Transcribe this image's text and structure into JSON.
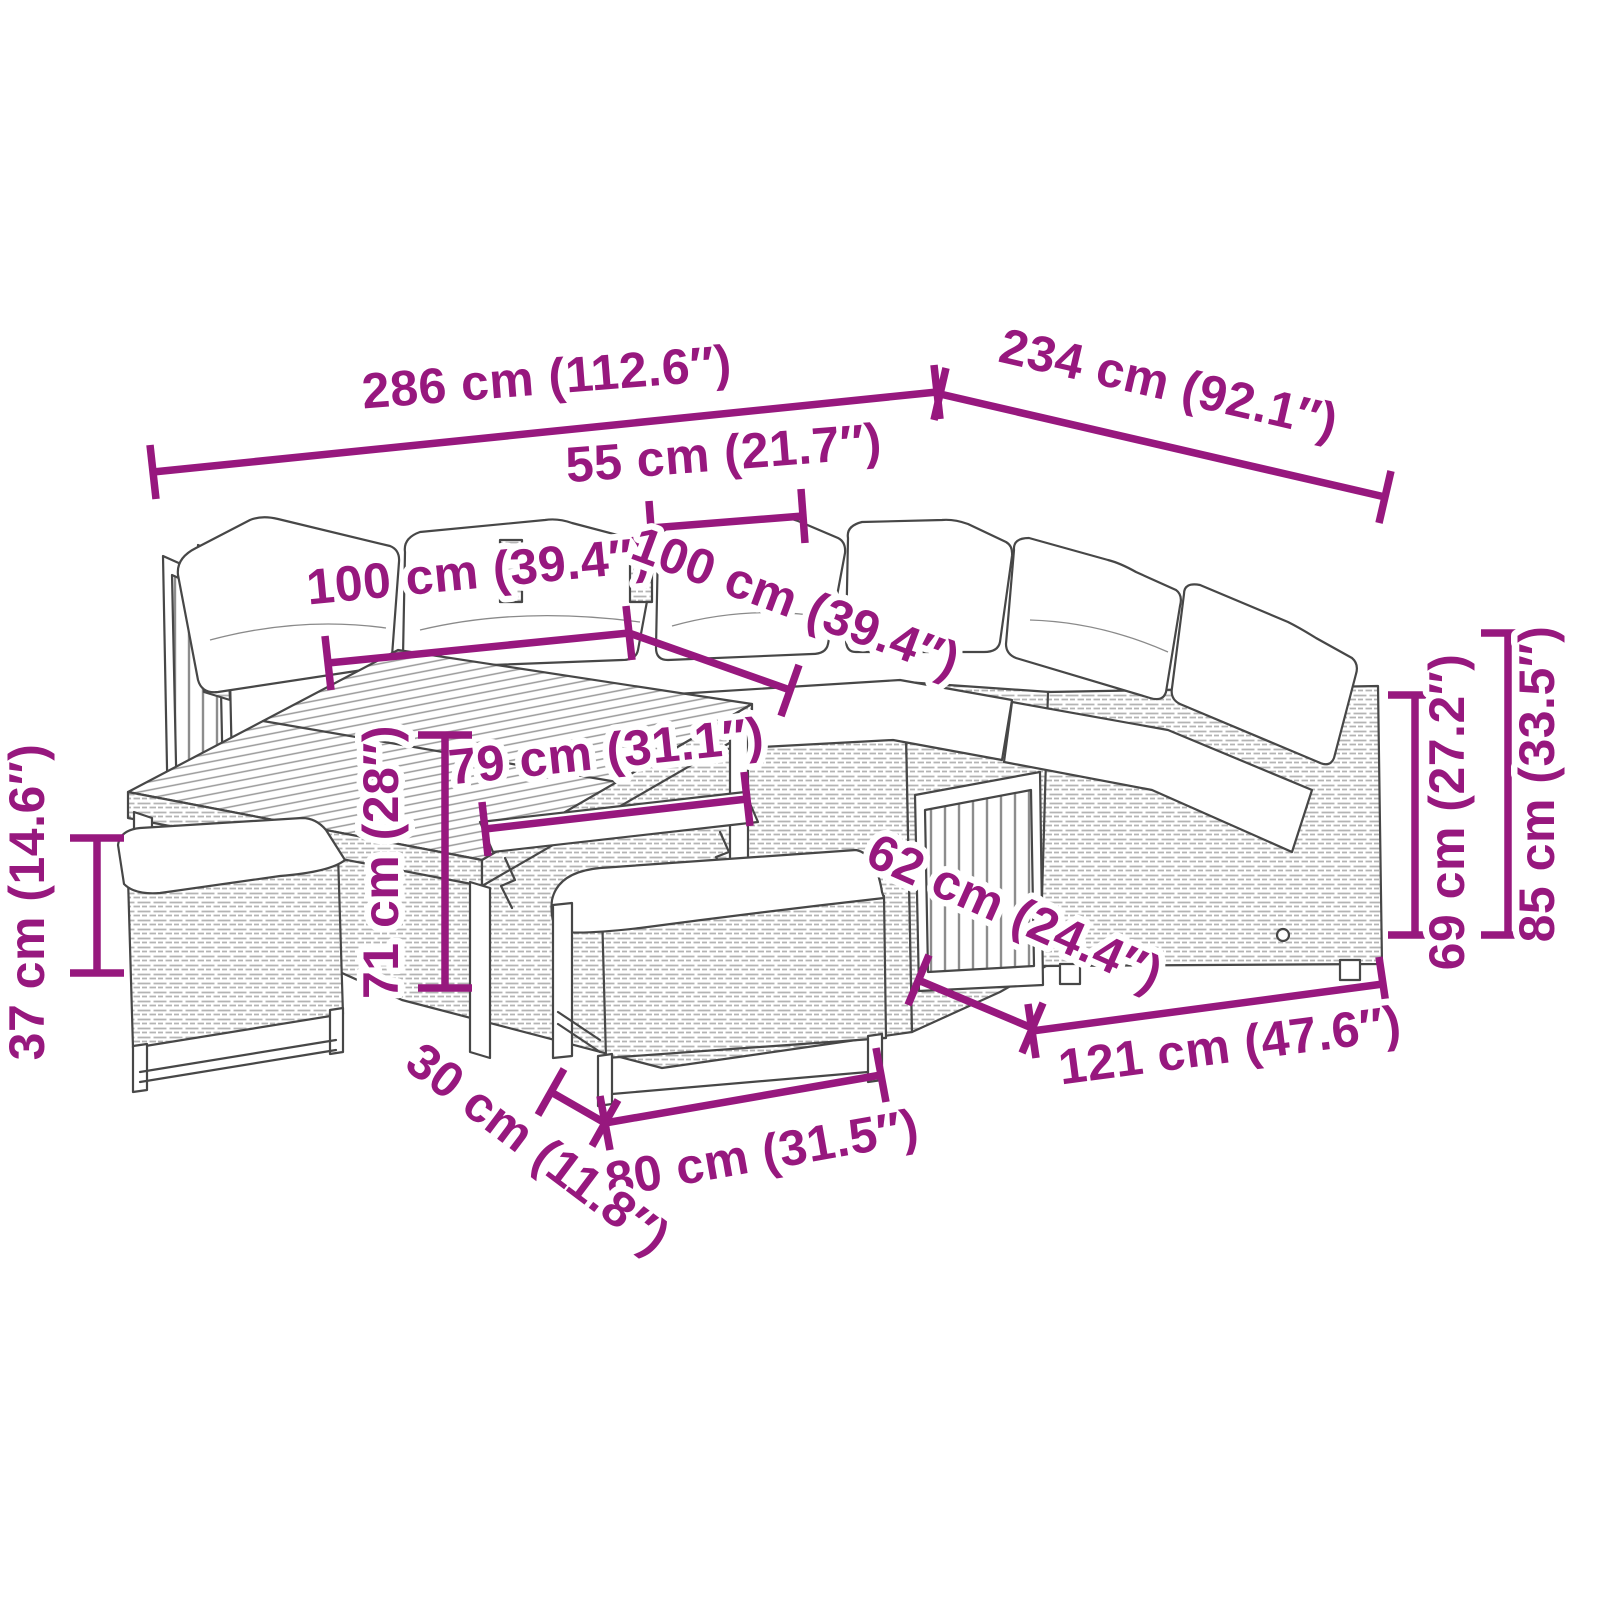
{
  "colors": {
    "dimension_accent": "#97187E",
    "line_art": "#474747",
    "background": "#FFFFFF"
  },
  "dimensions": [
    {
      "id": "total-width",
      "cm": "286 cm",
      "inches": "112.6″",
      "label": "286 cm (112.6″)"
    },
    {
      "id": "total-depth",
      "cm": "234 cm",
      "inches": "92.1″",
      "label": "234 cm (92.1″)"
    },
    {
      "id": "table-top-side",
      "cm": "55 cm",
      "inches": "21.7″",
      "label": "55 cm (21.7″)"
    },
    {
      "id": "left-section",
      "cm": "100 cm",
      "inches": "39.4″",
      "label": "100 cm (39.4″)"
    },
    {
      "id": "right-section",
      "cm": "100 cm",
      "inches": "39.4″",
      "label": "100 cm (39.4″)"
    },
    {
      "id": "table-width",
      "cm": "79 cm",
      "inches": "31.1″",
      "label": "79 cm (31.1″)"
    },
    {
      "id": "table-height",
      "cm": "71 cm",
      "inches": "28″",
      "label": "71 cm (28″)"
    },
    {
      "id": "stool-height",
      "cm": "37 cm",
      "inches": "14.6″",
      "label": "37 cm (14.6″)"
    },
    {
      "id": "seat-depth",
      "cm": "62 cm",
      "inches": "24.4″",
      "label": "62 cm (24.4″)"
    },
    {
      "id": "sofa-width",
      "cm": "121 cm",
      "inches": "47.6″",
      "label": "121 cm (47.6″)"
    },
    {
      "id": "bench-width",
      "cm": "80 cm",
      "inches": "31.5″",
      "label": "80 cm (31.5″)"
    },
    {
      "id": "bench-depth",
      "cm": "30 cm",
      "inches": "11.8″",
      "label": "30 cm (11.8″)"
    },
    {
      "id": "back-height",
      "cm": "69 cm",
      "inches": "27.2″",
      "label": "69 cm (27.2″)"
    },
    {
      "id": "total-height",
      "cm": "85 cm",
      "inches": "33.5″",
      "label": "85 cm (33.5″)"
    }
  ]
}
